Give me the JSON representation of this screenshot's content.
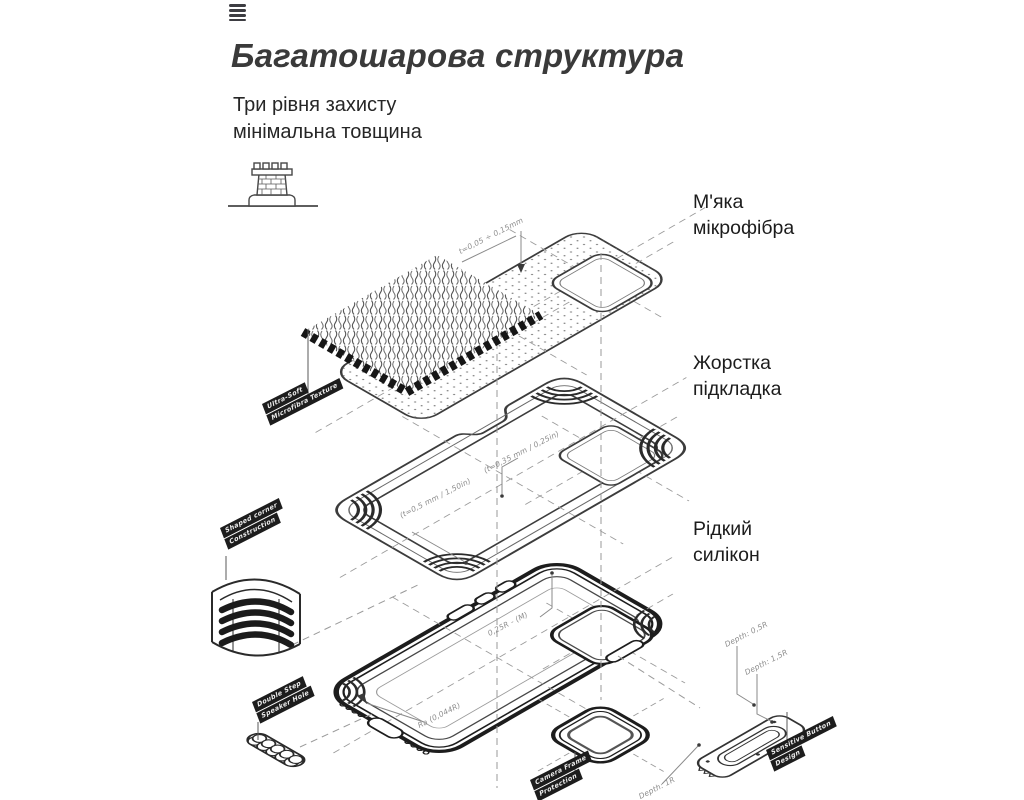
{
  "header": {
    "title": "Багатошарова структура",
    "subtitle_line1": "Три рівня захисту",
    "subtitle_line2": "мінімальна товщина"
  },
  "layer_labels": {
    "microfiber": {
      "line1": "М'яка",
      "line2": "мікрофібра"
    },
    "hard_liner": {
      "line1": "Жорстка",
      "line2": "підкладка"
    },
    "silicone": {
      "line1": "Рідкий",
      "line2": "силікон"
    }
  },
  "diagram": {
    "tags": {
      "ultra_soft": {
        "line1": "Ultra-Soft",
        "line2": "Microfibra Texture"
      },
      "shaped_corner": {
        "line1": "Shaped corner",
        "line2": "Construction"
      },
      "double_step": {
        "line1": "Double Step",
        "line2": "Speaker Hole"
      },
      "camera_frame": {
        "line1": "Camera Frame",
        "line2": "Protection"
      },
      "sensitive_button": {
        "line1": "Sensitive Button",
        "line2": "Design"
      }
    },
    "dimensions": {
      "microfiber_thickness": "t=0,05 ÷ 0,15mm",
      "liner_thickness_top": "(t=0,35 mm / 0,25in)",
      "liner_thickness_bottom": "(t=0,5 mm / 1,50in)",
      "case_radius": "0,25R - (M)",
      "case_surface": "Ra (0,044R)",
      "button_depth_1": "Depth: 0,5R",
      "button_depth_2": "Depth: 1,5R",
      "button_depth_3": "Depth: 1R"
    }
  },
  "colors": {
    "ink": "#3a3a3a",
    "outline": "#2d2d2d",
    "dash": "#9a9a9a",
    "tag_bg": "#1d1d1d",
    "background": "#ffffff"
  }
}
